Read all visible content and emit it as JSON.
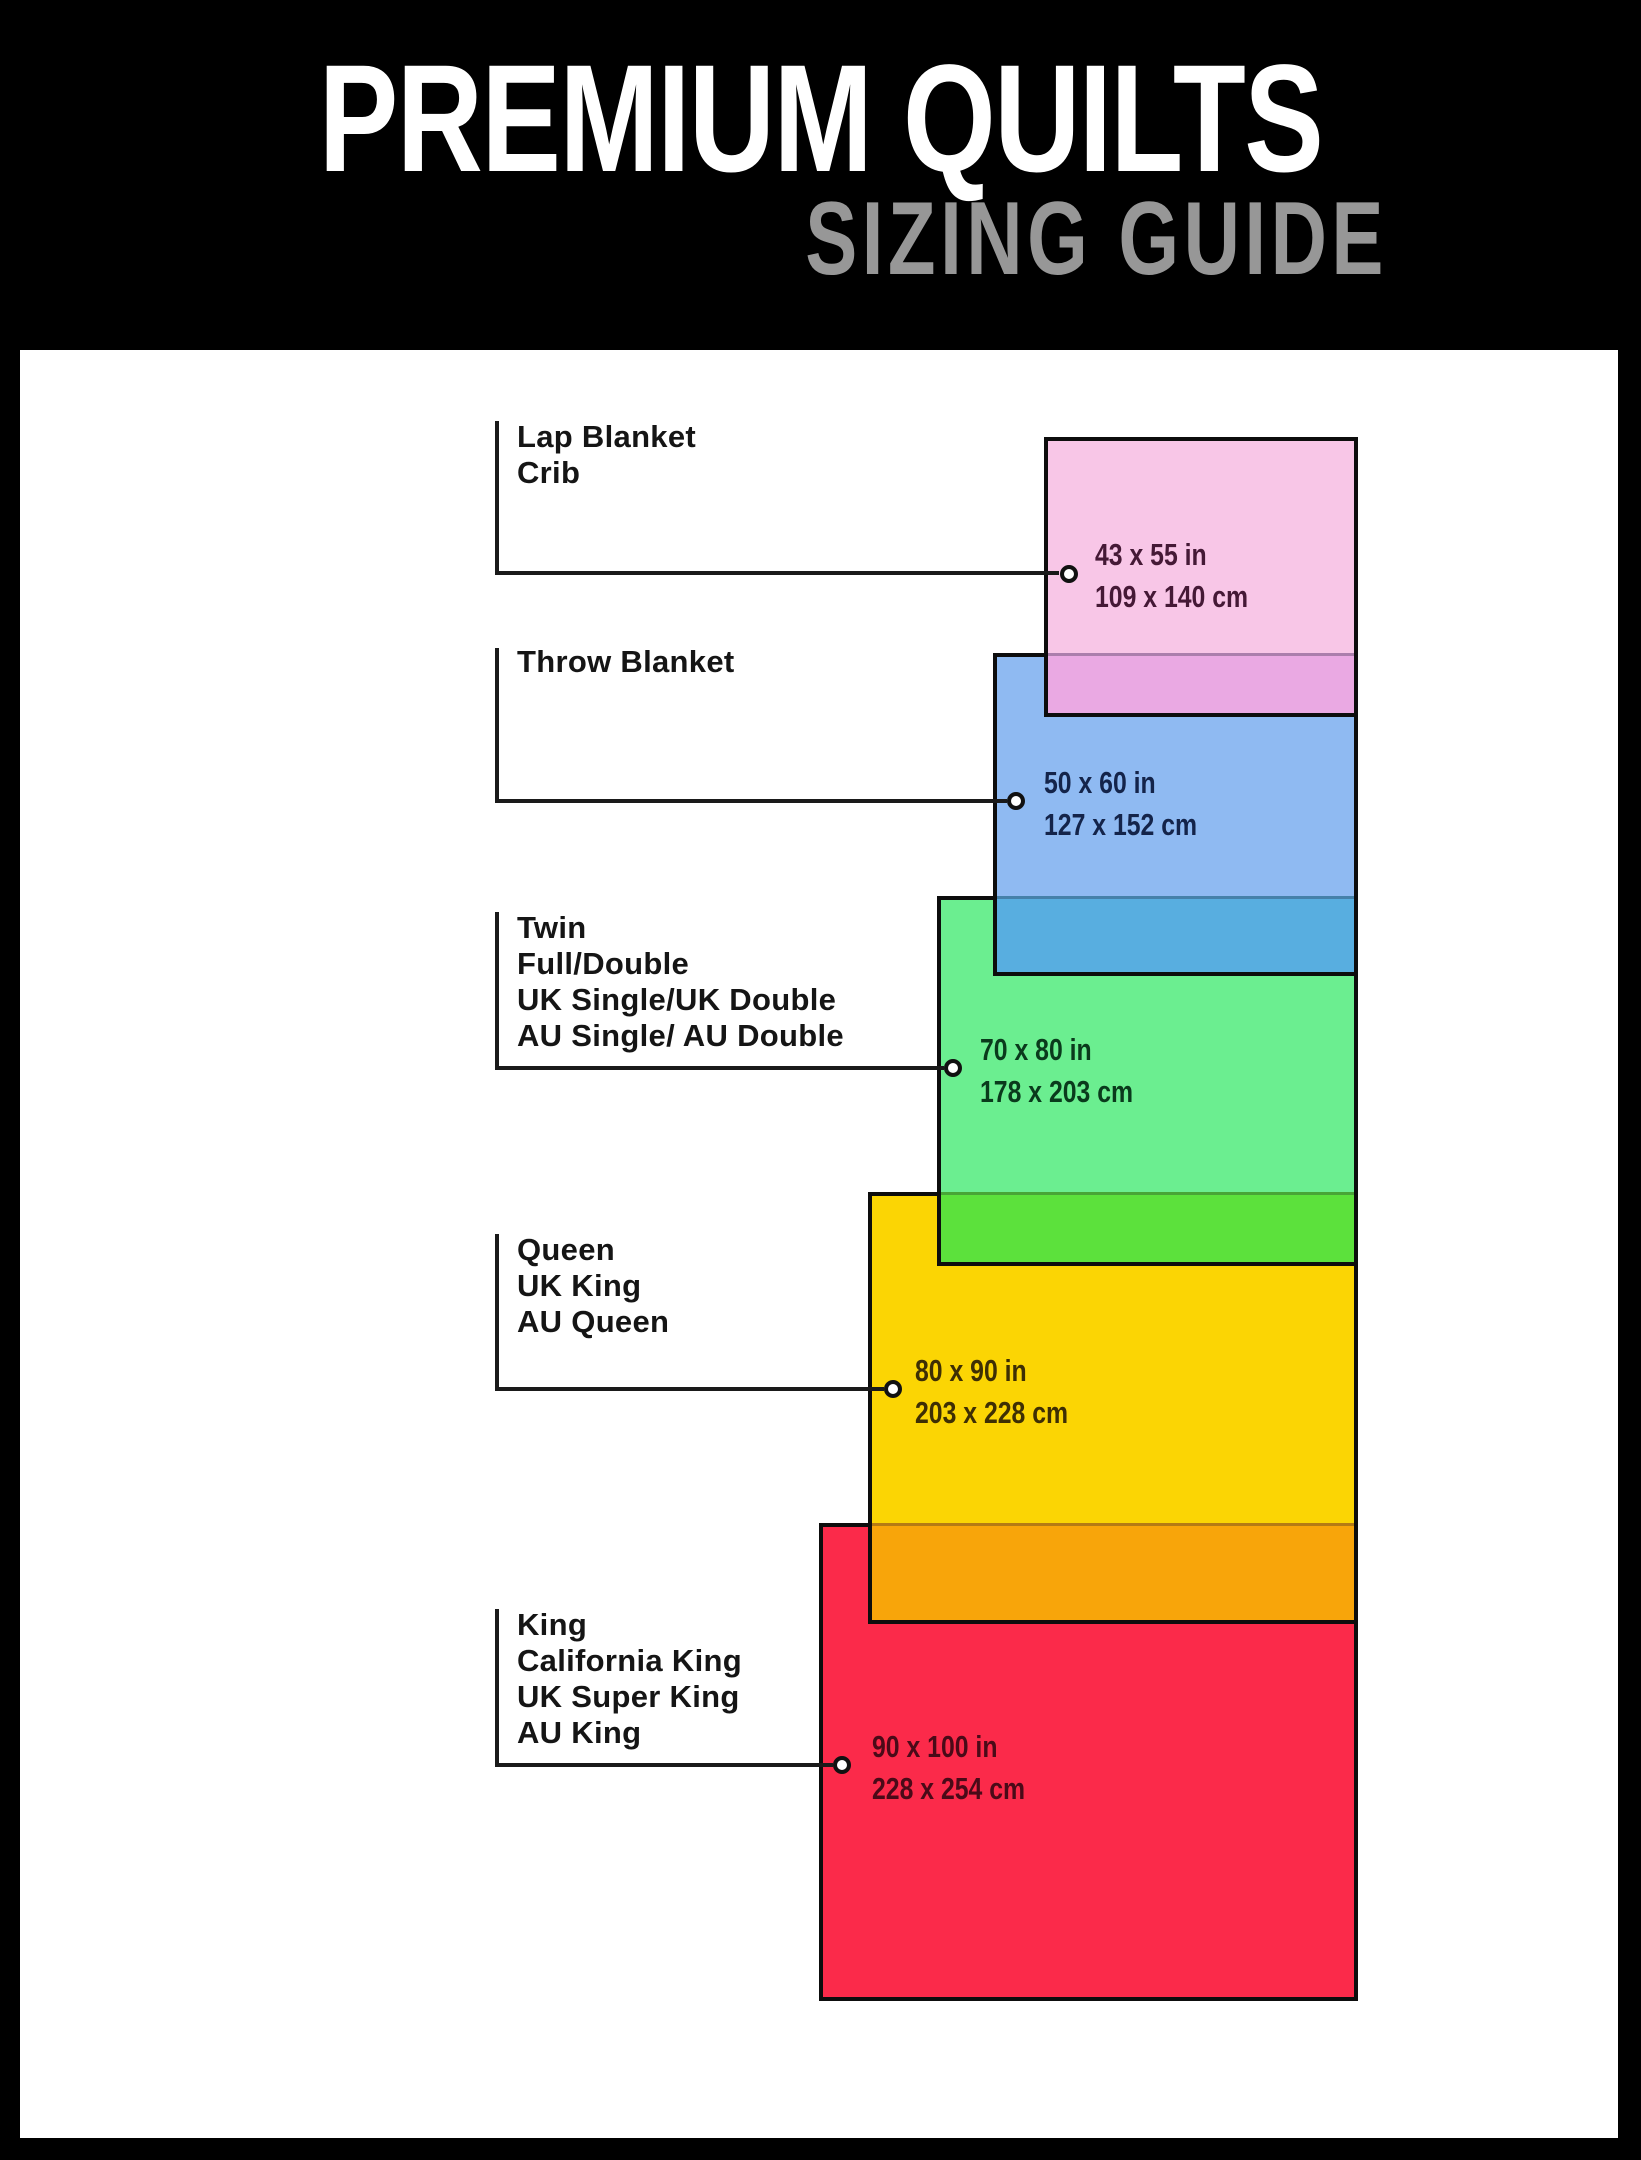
{
  "header": {
    "title": "PREMIUM QUILTS",
    "subtitle": "SIZING GUIDE",
    "background": "#000000",
    "title_color": "#FFFFFF",
    "subtitle_color": "#979797"
  },
  "canvas": {
    "background": "#FFFFFF",
    "frame_color": "#000000",
    "connector_color": "#1A1A1A",
    "rect_border_color": "#0D0D0D"
  },
  "sizes": [
    {
      "id": "lap-blanket-crib",
      "labels": [
        "Lap Blanket",
        "Crib"
      ],
      "inches": "43 x 55 in",
      "cm": "109 x 140 cm",
      "width_in": 43,
      "height_in": 55,
      "width_cm": 109,
      "height_cm": 140,
      "fill": "#F8C6E7",
      "overlap_fill": "#EAA9E3",
      "dim_text_color": "#451936"
    },
    {
      "id": "throw-blanket",
      "labels": [
        "Throw Blanket"
      ],
      "inches": "50 x 60 in",
      "cm": "127 x 152 cm",
      "width_in": 50,
      "height_in": 60,
      "width_cm": 127,
      "height_cm": 152,
      "fill": "#8FBAF2",
      "overlap_fill": "#58AEE0",
      "dim_text_color": "#14244A"
    },
    {
      "id": "twin-full-double",
      "labels": [
        "Twin",
        "Full/Double",
        "UK Single/UK Double",
        "AU Single/ AU Double"
      ],
      "inches": "70 x 80 in",
      "cm": "178 x 203 cm",
      "width_in": 70,
      "height_in": 80,
      "width_cm": 178,
      "height_cm": 203,
      "fill": "#6BEE90",
      "overlap_fill": "#5CE13C",
      "dim_text_color": "#0A3A1C"
    },
    {
      "id": "queen-uk-king-au-queen",
      "labels": [
        "Queen",
        "UK King",
        "AU Queen"
      ],
      "inches": "80 x 90 in",
      "cm": "203 x 228 cm",
      "width_in": 80,
      "height_in": 90,
      "width_cm": 203,
      "height_cm": 228,
      "fill": "#FBD504",
      "overlap_fill": "#F8A50A",
      "dim_text_color": "#3E2F04"
    },
    {
      "id": "king-california-king",
      "labels": [
        "King",
        "California King",
        "UK Super King",
        "AU King"
      ],
      "inches": "90 x 100 in",
      "cm": "228 x 254 cm",
      "width_in": 90,
      "height_in": 100,
      "width_cm": 228,
      "height_cm": 254,
      "fill": "#FB2A4A",
      "overlap_fill": null,
      "dim_text_color": "#4A0A18"
    }
  ]
}
